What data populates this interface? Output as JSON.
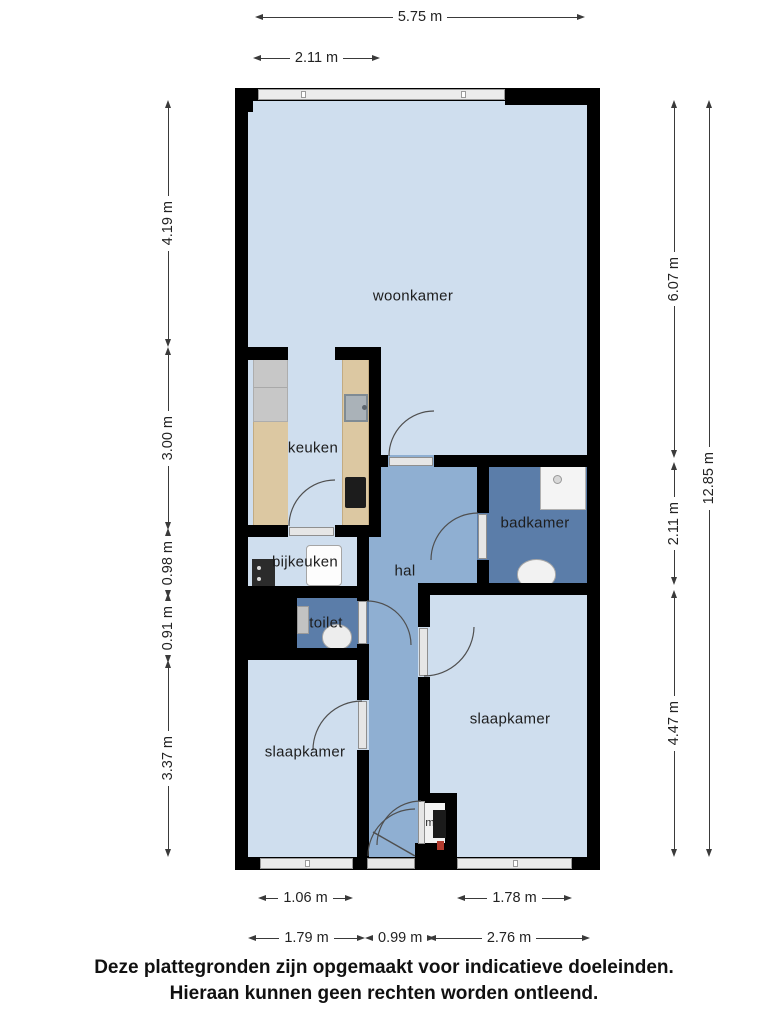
{
  "title": "Plattegrond",
  "rooms": {
    "woonkamer": "woonkamer",
    "keuken": "keuken",
    "bijkeuken": "bijkeuken",
    "hal": "hal",
    "badkamer": "badkamer",
    "toilet": "toilet",
    "slaapkamer_left": "slaapkamer",
    "slaapkamer_right": "slaapkamer",
    "mk": "mk"
  },
  "dims": {
    "top_total": "5.75 m",
    "top_partial": "2.11 m",
    "left_1": "4.19 m",
    "left_2": "3.00 m",
    "left_3": "0.98 m",
    "left_4": "0.91 m",
    "left_5": "3.37 m",
    "right_1": "6.07 m",
    "right_2": "2.11 m",
    "right_3": "4.47 m",
    "right_total": "12.85 m",
    "bottom_window_left": "1.06 m",
    "bottom_window_right": "1.78 m",
    "bottom_1": "1.79 m",
    "bottom_2": "0.99 m",
    "bottom_3": "2.76 m"
  },
  "footer": {
    "line1": "Deze plattegronden zijn opgemaakt voor indicatieve doeleinden.",
    "line2": "Hieraan kunnen geen rechten worden ontleend."
  },
  "colors": {
    "wall": "#000000",
    "floor_light": "#cfdeee",
    "floor_hall": "#8fafd2",
    "floor_wet": "#5b7da9",
    "floor_mk": "#f2f2f2",
    "counter": "#dcc8a2",
    "appliance_gray": "#c7c7c7",
    "window_fill": "#ececec",
    "dim_line": "#3a3a3a",
    "text": "#1d1d1d"
  }
}
